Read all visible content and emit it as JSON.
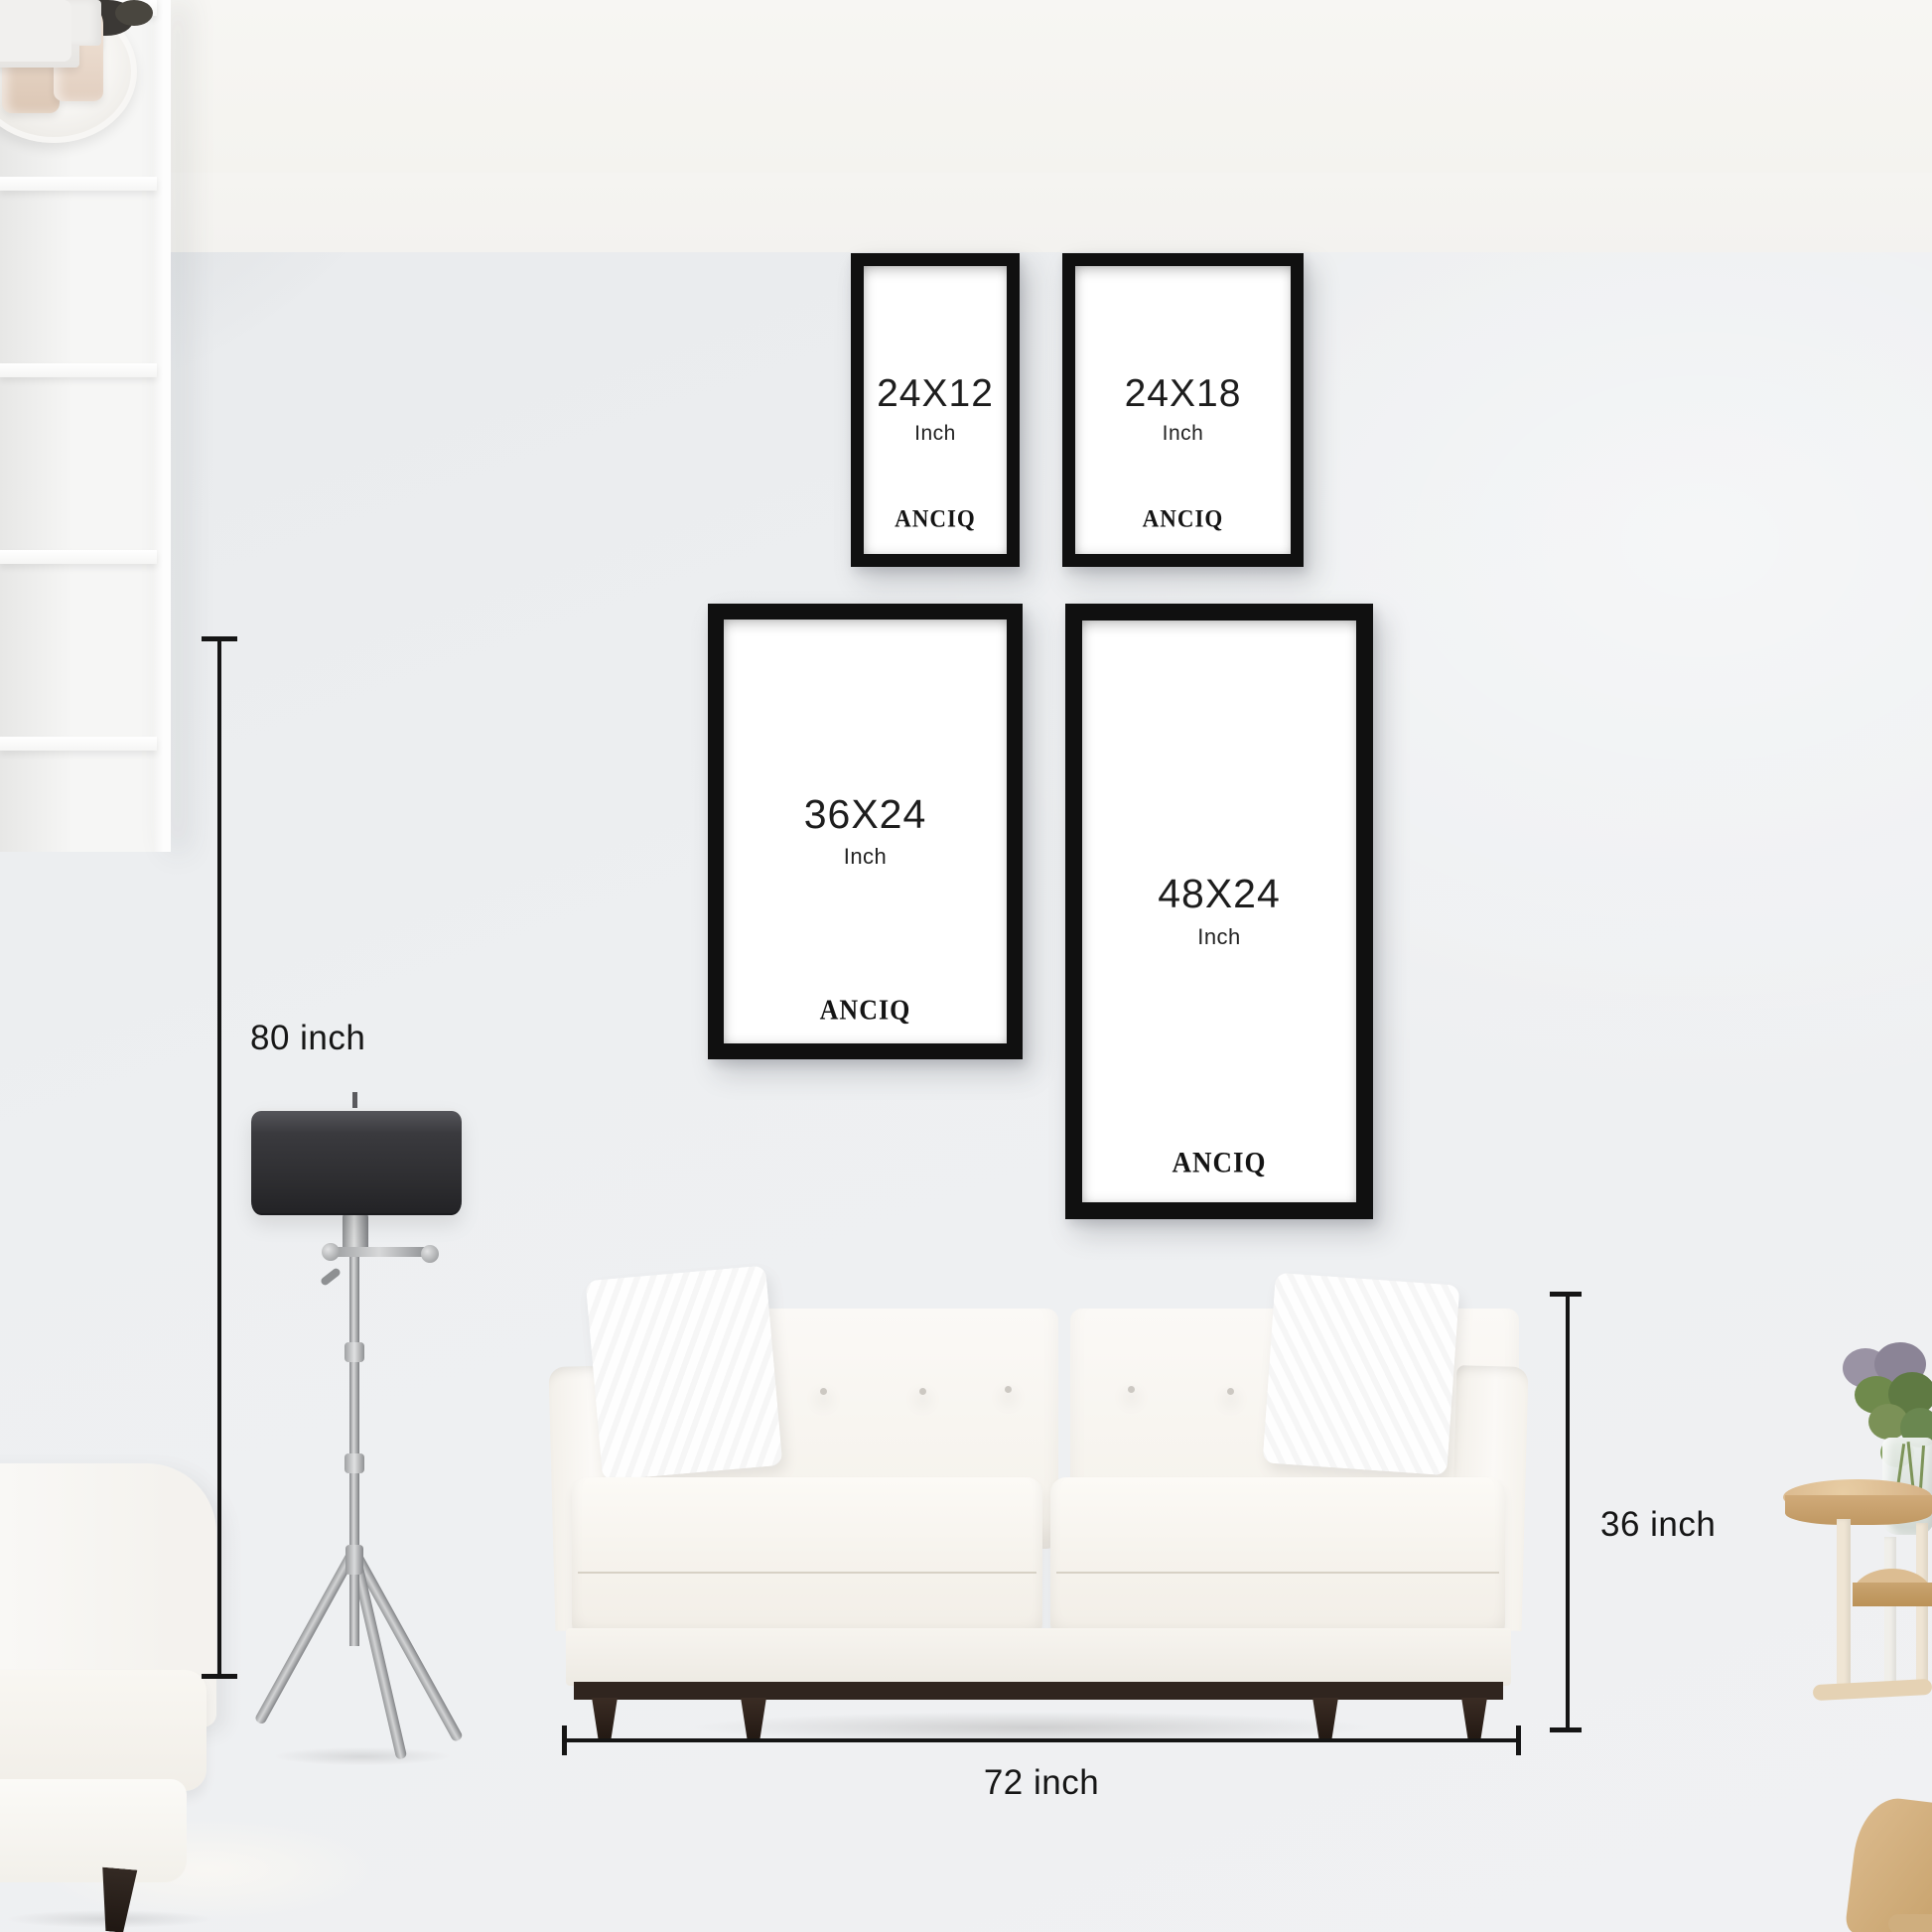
{
  "brand": "ANCIQ",
  "frames": [
    {
      "size_label": "24X12",
      "unit_label": "Inch",
      "brand_label": "ANCIQ"
    },
    {
      "size_label": "24X18",
      "unit_label": "Inch",
      "brand_label": "ANCIQ"
    },
    {
      "size_label": "36X24",
      "unit_label": "Inch",
      "brand_label": "ANCIQ"
    },
    {
      "size_label": "48X24",
      "unit_label": "Inch",
      "brand_label": "ANCIQ"
    }
  ],
  "dimensions": {
    "wall_height_label": "80 inch",
    "sofa_height_label": "36 inch",
    "sofa_width_label": "72 inch"
  },
  "colors": {
    "frame_border": "#101010",
    "frame_interior": "#ffffff",
    "label_text": "#1d1d1d",
    "dimension_line": "#151515",
    "wall": "#edeff1",
    "floor": "#f4f3f1",
    "sofa_fabric": "#f8f6f2",
    "sofa_wood": "#30251f",
    "lamp_shade": "#2d2d30"
  }
}
